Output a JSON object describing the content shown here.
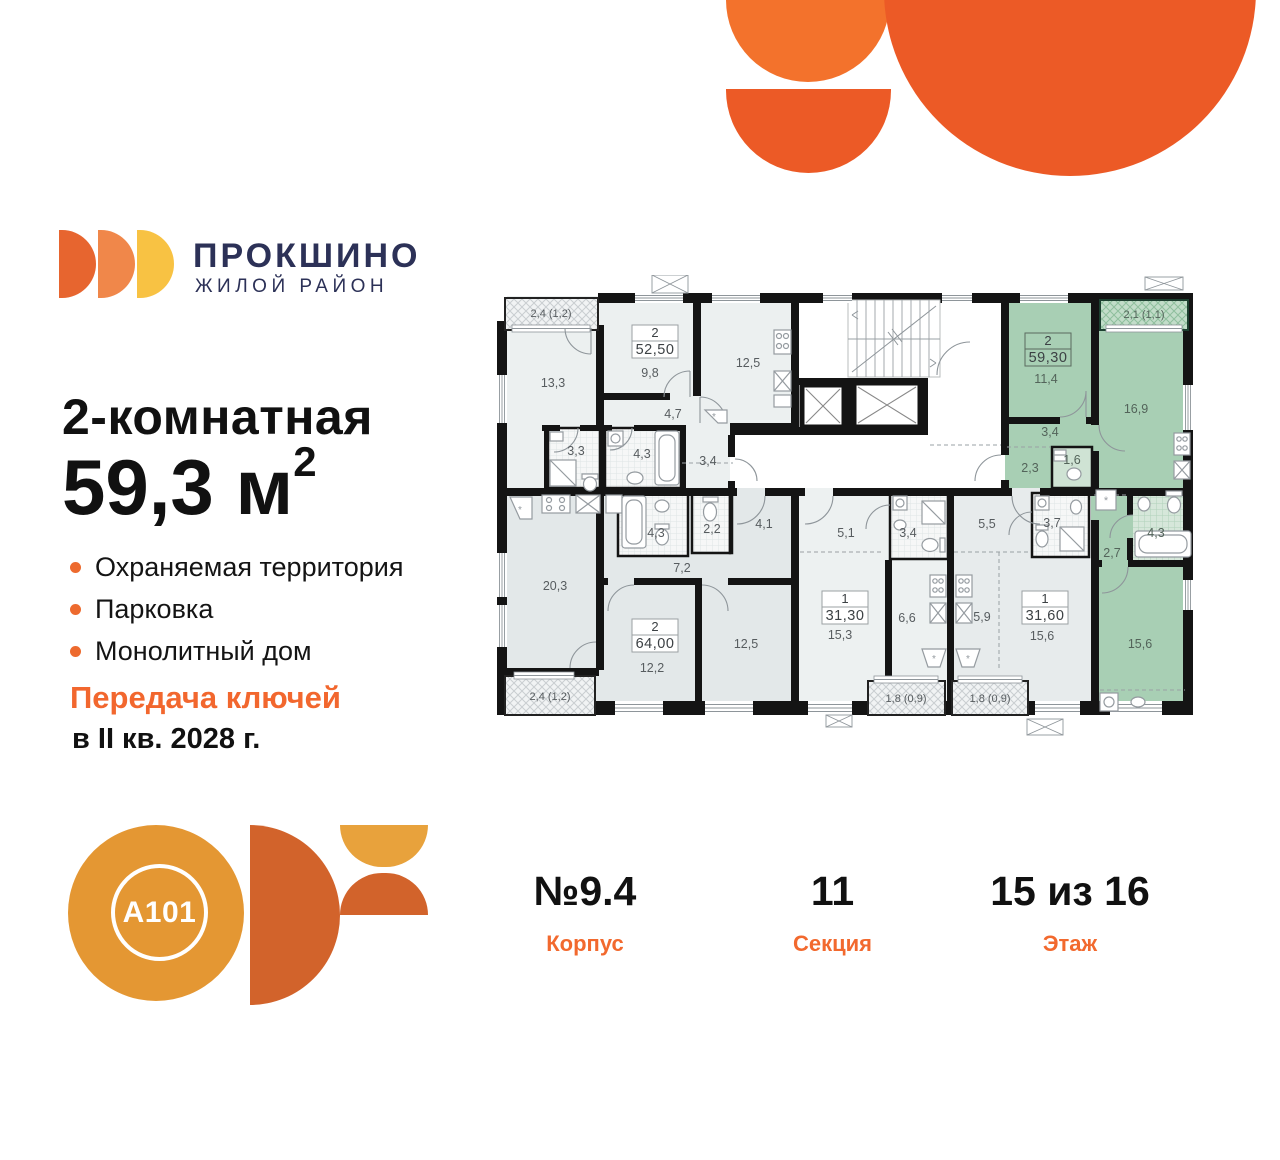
{
  "brand": {
    "name": "ПРОКШИНО",
    "tagline": "ЖИЛОЙ РАЙОН"
  },
  "hero": {
    "type_label": "2-комнатная",
    "area_value": "59,3 м",
    "area_sup": "2",
    "features": [
      "Охраняемая территория",
      "Парковка",
      "Монолитный дом"
    ],
    "handover_line1": "Передача ключей",
    "handover_line2": "в II кв. 2028 г."
  },
  "developer": {
    "logo_text": "A101"
  },
  "footer": {
    "building": {
      "value": "№9.4",
      "label": "Корпус"
    },
    "section": {
      "value": "11",
      "label": "Секция"
    },
    "floor": {
      "value": "15 из 16",
      "label": "Этаж"
    }
  },
  "floorplan": {
    "highlighted": {
      "rooms_count": "2",
      "area": "59,30",
      "rooms": [
        "11,4",
        "16,9",
        "3,4",
        "2,3",
        "1,6",
        "2,7",
        "4,3",
        "15,6"
      ],
      "balcony": "2,1 (1,1)"
    },
    "apartments": [
      {
        "rooms_count": "2",
        "area": "52,50",
        "rooms": [
          "13,3",
          "9,8",
          "12,5",
          "4,7",
          "3,3",
          "4,3",
          "3,4"
        ],
        "balcony": "2,4 (1,2)"
      },
      {
        "rooms_count": "2",
        "area": "64,00",
        "rooms": [
          "20,3",
          "7,2",
          "4,3",
          "2,2",
          "4,1",
          "12,2",
          "12,5"
        ],
        "balcony": "2,4 (1,2)"
      },
      {
        "rooms_count": "1",
        "area": "31,30",
        "rooms": [
          "5,1",
          "3,4",
          "15,3",
          "6,6"
        ],
        "balcony": "1,8 (0,9)"
      },
      {
        "rooms_count": "1",
        "area": "31,60",
        "rooms": [
          "5,5",
          "3,7",
          "5,9",
          "15,6"
        ],
        "balcony": "1,8 (0,9)"
      }
    ]
  },
  "colors": {
    "accent_orange": "#EC5A26",
    "brand_navy": "#2C3157",
    "highlight_green": "#A8CFB4",
    "amber": "#E49733"
  }
}
